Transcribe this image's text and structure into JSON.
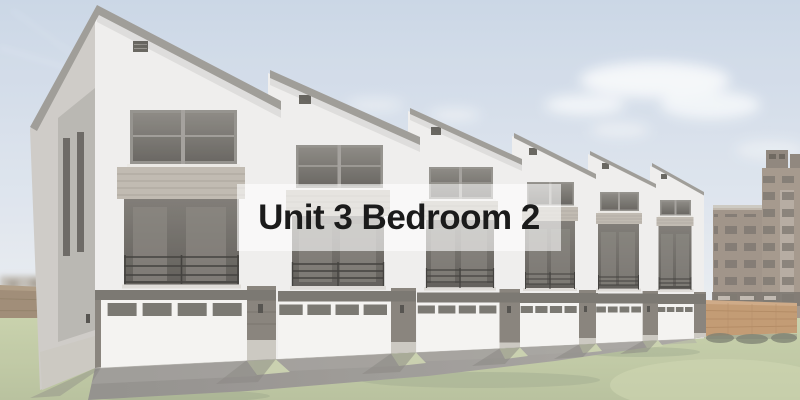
{
  "image": {
    "type": "architectural-rendering",
    "caption": "Unit 3 Bedroom 2",
    "description": "Washed-out exterior rendering: row of six modern shed-roof townhomes with recessed balconies and white garage doors, asphalt drive lane, lawn, wood privacy fences, and older apartment buildings at right under a hazy blue sky with clouds; translucent white caption band across the center."
  },
  "palette": {
    "sky_top": "#c6d3e4",
    "sky_horizon": "#eaedf1",
    "cloud": "#f6f8fa",
    "wall": "#eeedeb",
    "wall_side": "#cac7c2",
    "roof_fascia": "#96938e",
    "window_frame": "#8b8883",
    "window_glass_top": "#817e78",
    "window_glass_bottom": "#5b5853",
    "siding": "#bab4aa",
    "recess_top": "#74706a",
    "recess_bottom": "#514e49",
    "railing": "#2f2d2a",
    "header_band": "#6e6a64",
    "pier": "#7d7870",
    "concrete": "#c7c3bc",
    "garage_door": "#f3f2f0",
    "garage_pane": "#6d6a64",
    "asphalt_near": "#8a8783",
    "asphalt_far": "#a29f9b",
    "grass_top": "#c3cda4",
    "grass_bottom": "#b2bc95",
    "grass_bright": "#c9d2aa",
    "grass_shadow": "#9aa585",
    "fence_right": "#bd9166",
    "fence_left": "#97826a",
    "bg_building_a": "#97897d",
    "bg_building_b": "#9c8f82",
    "bg_window": "#6f6761",
    "caption_text": "#1b1b1b"
  }
}
